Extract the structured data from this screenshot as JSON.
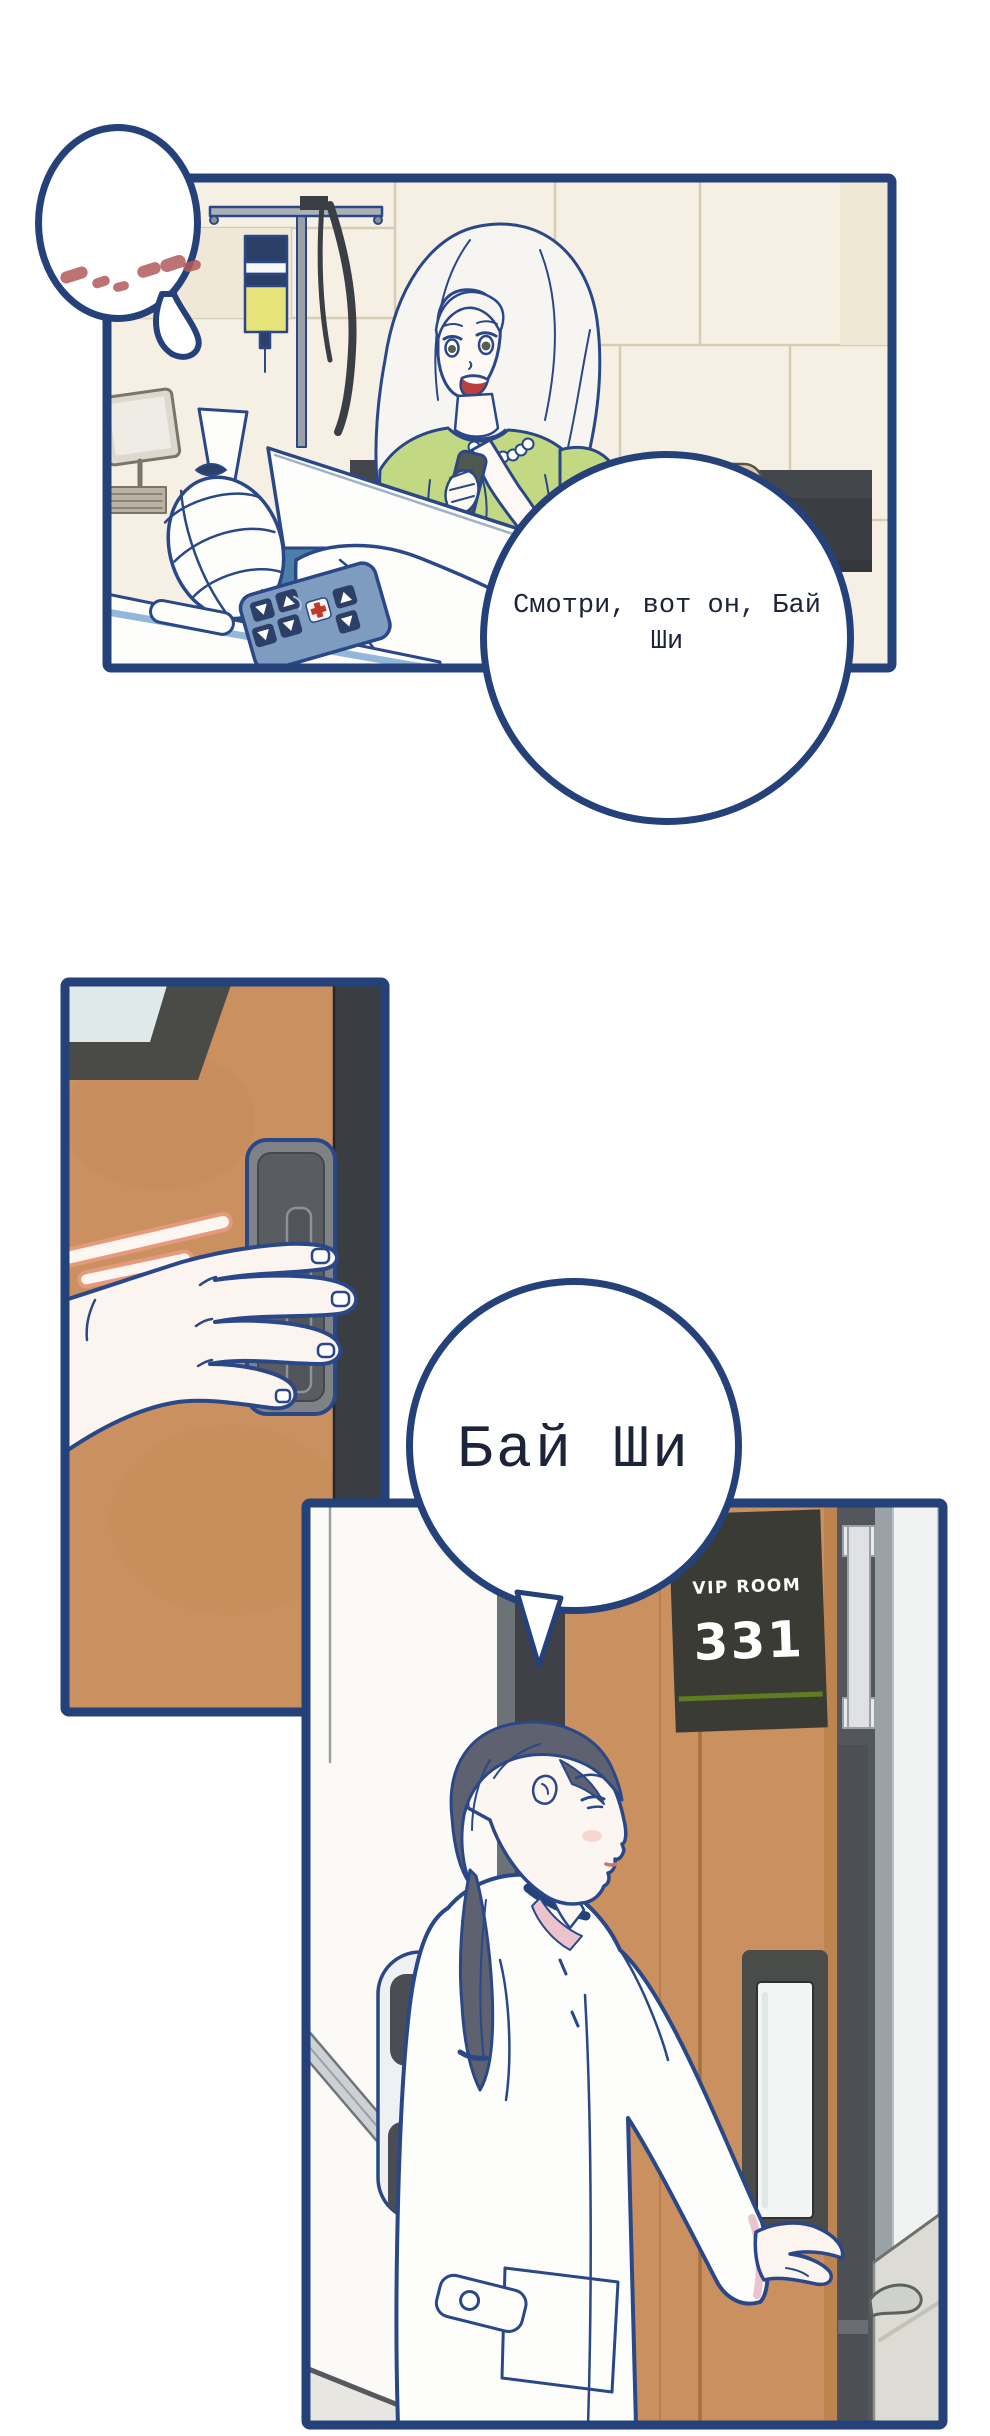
{
  "page": {
    "background": "#ffffff",
    "panel_border_color": "#24417a",
    "ink_color": "#2a4887"
  },
  "bubbles": {
    "ellipsis": {
      "type": "silent-dots",
      "dot_color": "#b25b5b",
      "dot_count": 6
    },
    "main": {
      "text": "Смотри, вот он, Бай Ши",
      "text_color": "#1b2438"
    },
    "name": {
      "text": "Бай Ши",
      "text_color": "#1b2438"
    }
  },
  "door_sign": {
    "label": "VIP ROOM",
    "number": "331",
    "background": "#3b3b36",
    "text_color": "#ffffff",
    "underline_color": "#5e7c20"
  },
  "palette": {
    "door_tan": "#ca9060",
    "dark_frame": "#3f4146",
    "green_blouse": "#c3d883",
    "pillow_blue": "#4e7fa8",
    "remote_blue": "#7e9cc0",
    "skin": "#fcf4ef",
    "hair_dark": "#5d6170",
    "motion_line": "#e59a7b",
    "wall_cream": "#f5f0e3",
    "sofa_cushion": "#dbcdab",
    "iv_fluid_yellow": "#e6e37a"
  }
}
